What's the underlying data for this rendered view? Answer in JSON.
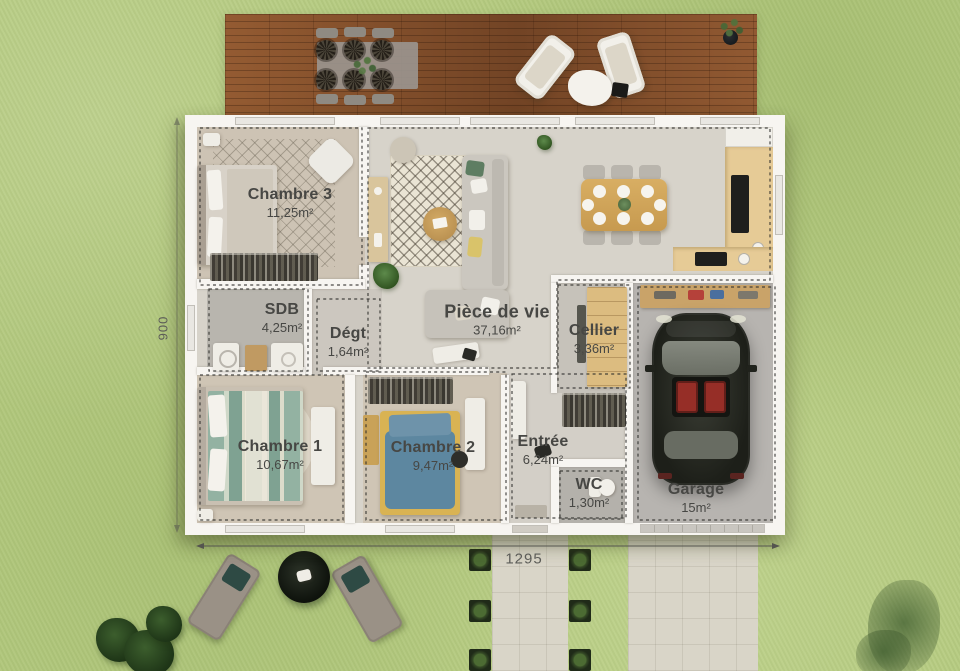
{
  "plan": {
    "rooms": [
      {
        "name": "Chambre 3",
        "area": "11,25m²"
      },
      {
        "name": "SDB",
        "area": "4,25m²"
      },
      {
        "name": "Dégt",
        "area": "1,64m²"
      },
      {
        "name": "Pièce de vie",
        "area": "37,16m²"
      },
      {
        "name": "Cellier",
        "area": "3,36m²"
      },
      {
        "name": "Chambre 1",
        "area": "10,67m²"
      },
      {
        "name": "Chambre 2",
        "area": "9,47m²"
      },
      {
        "name": "Entrée",
        "area": "6,24m²"
      },
      {
        "name": "WC",
        "area": "1,30m²"
      },
      {
        "name": "Garage",
        "area": "15m²"
      }
    ],
    "dimensions": {
      "width": "1295",
      "height": "900"
    }
  },
  "colors": {
    "grass": "#b6cb81",
    "deck": "#854f2b",
    "wall": "#f7f5f1",
    "floor": "#d7d3ca",
    "concrete": "#d9d5c8",
    "label": "#474744",
    "dash": "#2e2e2b",
    "car_body": "#22241e",
    "bed1_stripes": "#8fb0a0",
    "bed2_blanket": "#d9b353",
    "bed2_duvet": "#5d87a0",
    "kitchen_wood": "#e6cb96"
  }
}
